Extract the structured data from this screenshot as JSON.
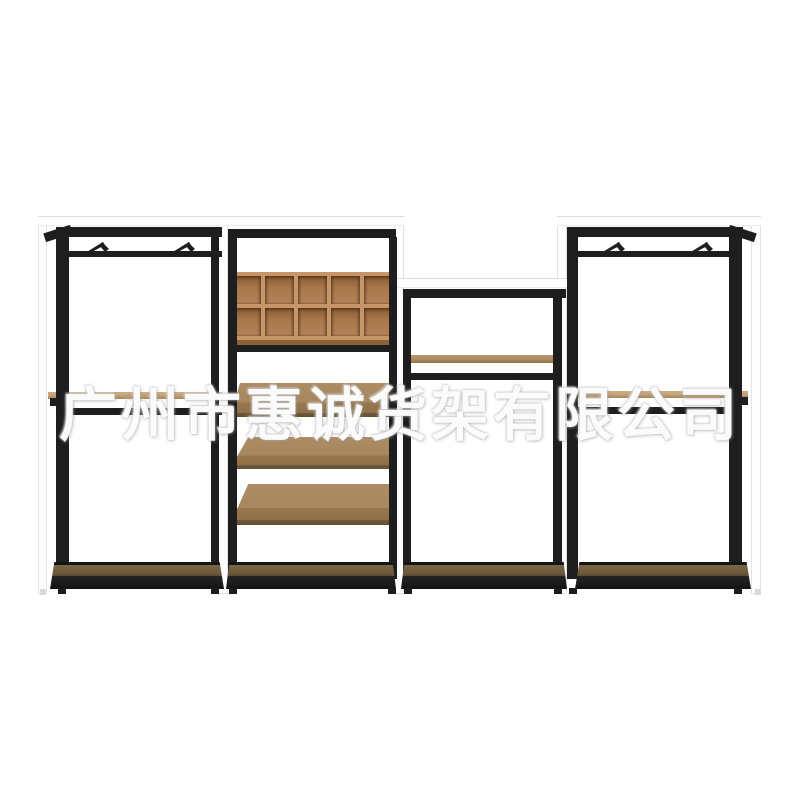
{
  "scene": {
    "type": "product-photo",
    "background_color": "#ffffff",
    "subject": "four-bay black metal garment display rack with wood accents on white background"
  },
  "watermark": {
    "text": "广州市惠诚货架有限公司",
    "color": "#ffffff"
  },
  "palette": {
    "metal_black": "#1e1e1e",
    "panel_white": "#fdfdfd",
    "panel_border": "#e3e3e3",
    "cubby_frame_wood": "#c49668",
    "cubby_cell_wood": "#a9784c",
    "shoe_shelf_wood": "#a8875f",
    "hang_rail_wood": "#c2a077",
    "display_shelf_wood": "#ac8a5e",
    "base_wood": "#6d593c"
  },
  "rack": {
    "bays": [
      {
        "id": "bay-1",
        "kind": "hanging-bay",
        "hooks": 2,
        "rails": [
          "wood-hang-rail",
          "metal-hang-rail"
        ],
        "base": "wood-base"
      },
      {
        "id": "bay-2",
        "kind": "cubby-shoe-bay",
        "cubby": {
          "rows": 2,
          "cols": 5
        },
        "tilted_shelves": 3,
        "base": "wood-base"
      },
      {
        "id": "bay-3",
        "kind": "low-display-bay",
        "wood_shelves": 1,
        "metal_rails": 1,
        "base": "wood-base"
      },
      {
        "id": "bay-4",
        "kind": "hanging-bay",
        "hooks": 2,
        "rails": [
          "wood-hang-rail",
          "metal-hang-rail"
        ],
        "base": "wood-base"
      }
    ]
  }
}
